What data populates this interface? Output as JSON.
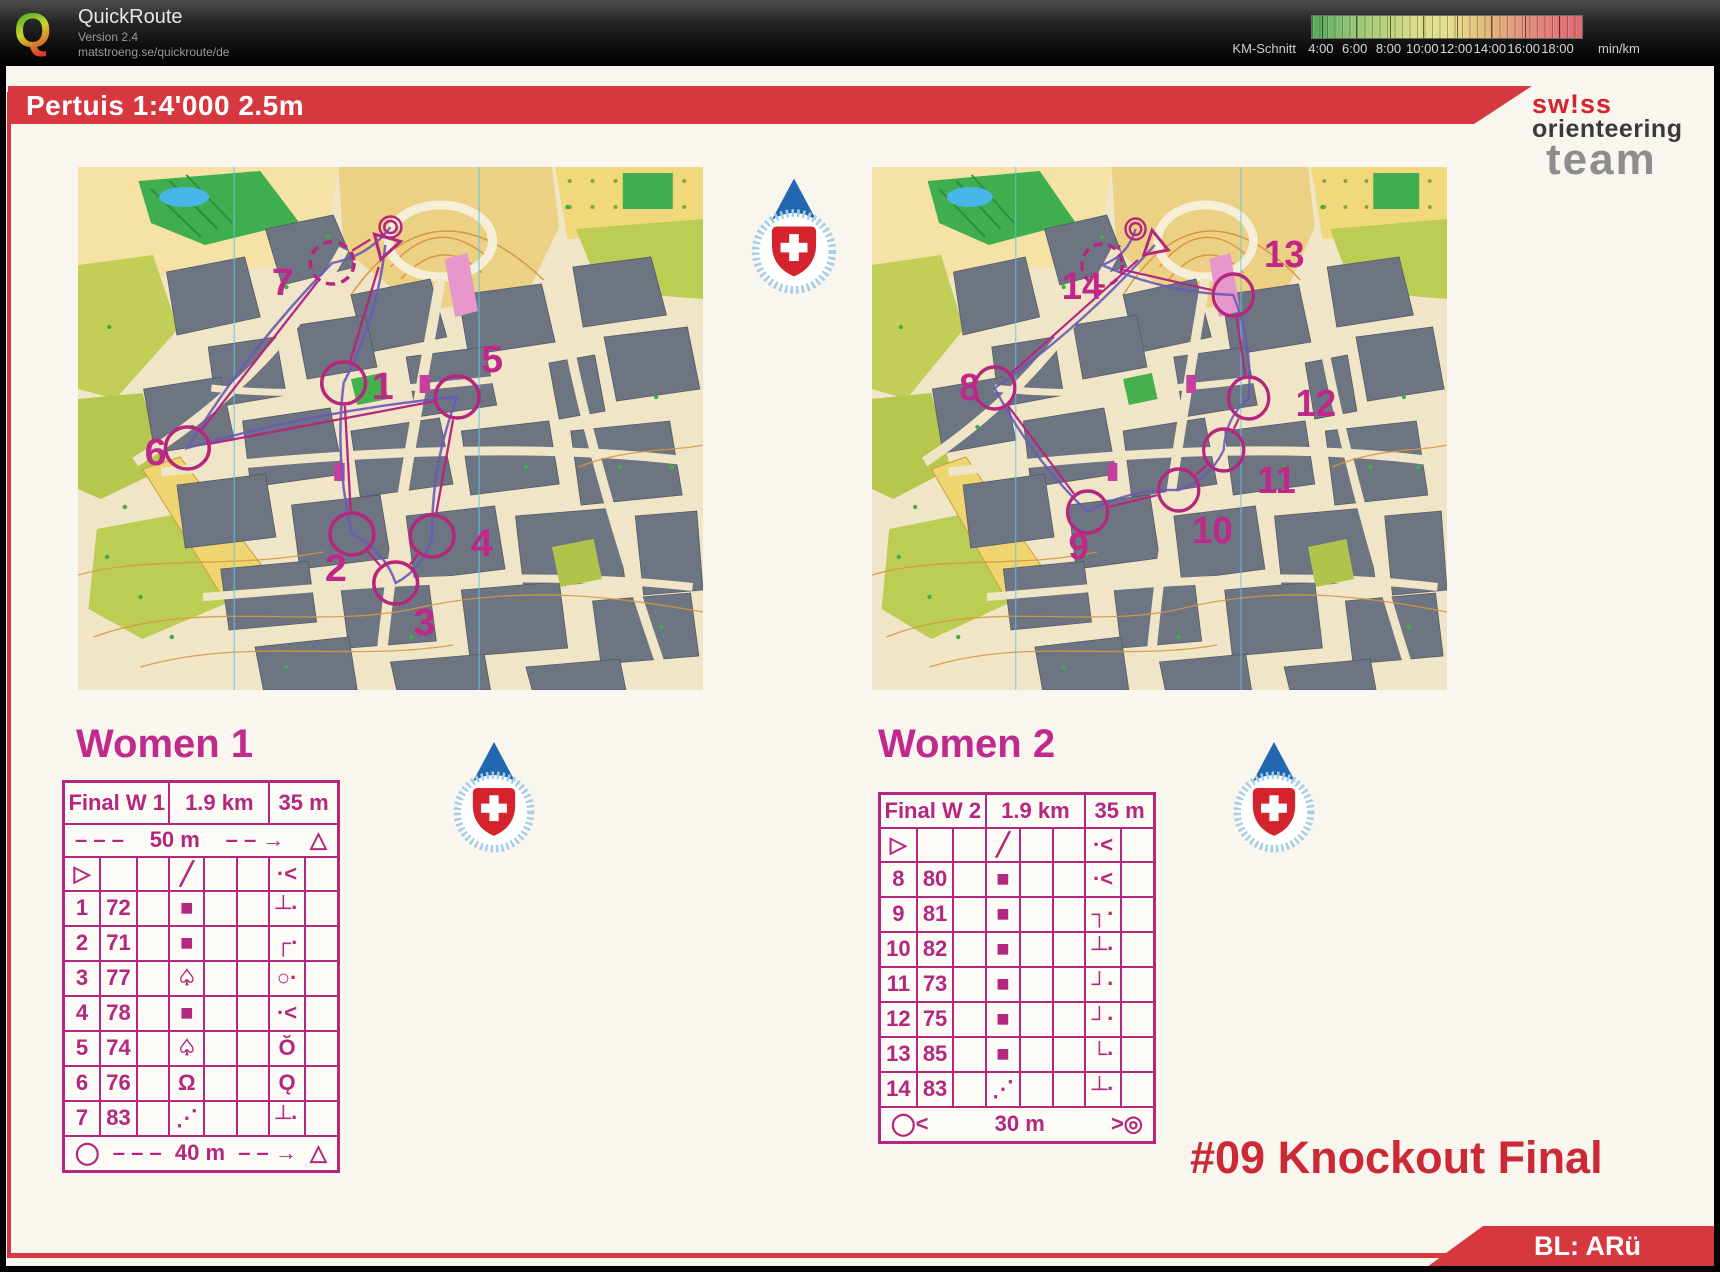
{
  "window": {
    "title": "QuickRoute",
    "version": "Version 2.4",
    "url": "matstroeng.se/quickroute/de"
  },
  "legend": {
    "label": "KM-Schnitt",
    "unit": "min/km",
    "ticks": [
      "4:00",
      "6:00",
      "8:00",
      "10:00",
      "12:00",
      "14:00",
      "16:00",
      "18:00"
    ],
    "colors": [
      "#55a85c",
      "#8cc273",
      "#b5d07c",
      "#d9dd85",
      "#e6e18a",
      "#e5c07d",
      "#e59a7e",
      "#e57d7d",
      "#df6a6e"
    ]
  },
  "sheet": {
    "map_title": "Pertuis 1:4'000 2.5m",
    "event_title": "#09 Knockout Final",
    "footer_tag": "BL: ARü",
    "logo_lines": [
      "sw!ss",
      "orienteering",
      "team"
    ],
    "accent_red": "#d7383f",
    "course_magenta": "#b5267f",
    "route_purple": "#6a5ab8"
  },
  "courses": [
    {
      "heading": "Women 1",
      "header": [
        "Final W 1",
        "1.9 km",
        "35 m"
      ],
      "pre_cells": [
        "– – –",
        "50 m",
        "– – →",
        "△"
      ],
      "start_symbols": [
        "start-triangle",
        "",
        "",
        "ramp",
        "",
        "",
        "dot-angle",
        ""
      ],
      "rows": [
        {
          "num": "1",
          "code": "72",
          "d": "building",
          "h": "edge-dot"
        },
        {
          "num": "2",
          "code": "71",
          "d": "building",
          "h": "corner-nw-dot"
        },
        {
          "num": "3",
          "code": "77",
          "d": "tree",
          "h": "circle-dot"
        },
        {
          "num": "4",
          "code": "78",
          "d": "building",
          "h": "dot-angle"
        },
        {
          "num": "5",
          "code": "74",
          "d": "tree",
          "h": "hook"
        },
        {
          "num": "6",
          "code": "76",
          "d": "statue",
          "h": "loop"
        },
        {
          "num": "7",
          "code": "83",
          "d": "stairs",
          "h": "edge-dot"
        }
      ],
      "finish_cells": [
        "◯",
        "– – –",
        "40 m",
        "– – →",
        "△"
      ],
      "dashed_controls": [
        "7"
      ],
      "controls": [
        {
          "label": "1",
          "cx": 255,
          "cy": 216,
          "lx": 282,
          "ly": 232
        },
        {
          "label": "2",
          "cx": 263,
          "cy": 367,
          "lx": 237,
          "ly": 414
        },
        {
          "label": "3",
          "cx": 305,
          "cy": 416,
          "lx": 322,
          "ly": 468
        },
        {
          "label": "4",
          "cx": 340,
          "cy": 369,
          "lx": 377,
          "ly": 389
        },
        {
          "label": "5",
          "cx": 364,
          "cy": 230,
          "lx": 387,
          "ly": 205
        },
        {
          "label": "6",
          "cx": 105,
          "cy": 281,
          "lx": 64,
          "ly": 298
        },
        {
          "label": "7",
          "cx": 244,
          "cy": 96,
          "lx": 186,
          "ly": 128
        }
      ],
      "route": [
        [
          295,
          78
        ],
        [
          255,
          216
        ],
        [
          263,
          367
        ],
        [
          305,
          416
        ],
        [
          340,
          369
        ],
        [
          364,
          230
        ],
        [
          105,
          281
        ],
        [
          244,
          96
        ],
        [
          300,
          60
        ]
      ]
    },
    {
      "heading": "Women 2",
      "header": [
        "Final W 2",
        "1.9 km",
        "35 m"
      ],
      "pre_cells": null,
      "start_symbols": [
        "start-triangle",
        "",
        "",
        "ramp",
        "",
        "",
        "dot-angle",
        ""
      ],
      "rows": [
        {
          "num": "8",
          "code": "80",
          "d": "building",
          "h": "dot-angle"
        },
        {
          "num": "9",
          "code": "81",
          "d": "building",
          "h": "corner-ne-dot"
        },
        {
          "num": "10",
          "code": "82",
          "d": "building",
          "h": "edge-dot"
        },
        {
          "num": "11",
          "code": "73",
          "d": "building",
          "h": "corner-se-dot"
        },
        {
          "num": "12",
          "code": "75",
          "d": "building",
          "h": "corner-se-dot"
        },
        {
          "num": "13",
          "code": "85",
          "d": "building",
          "h": "corner-sw-dot"
        },
        {
          "num": "14",
          "code": "83",
          "d": "stairs",
          "h": "edge-dot"
        }
      ],
      "finish_cells": [
        "◯<",
        "",
        "30 m",
        "",
        ">◎"
      ],
      "dashed_controls": [
        "14"
      ],
      "controls": [
        {
          "label": "8",
          "cx": 128,
          "cy": 221,
          "lx": 91,
          "ly": 233
        },
        {
          "label": "9",
          "cx": 225,
          "cy": 345,
          "lx": 205,
          "ly": 392
        },
        {
          "label": "10",
          "cx": 320,
          "cy": 323,
          "lx": 334,
          "ly": 376
        },
        {
          "label": "11",
          "cx": 367,
          "cy": 283,
          "lx": 402,
          "ly": 326
        },
        {
          "label": "12",
          "cx": 393,
          "cy": 231,
          "lx": 442,
          "ly": 249
        },
        {
          "label": "13",
          "cx": 377,
          "cy": 128,
          "lx": 409,
          "ly": 100
        },
        {
          "label": "14",
          "cx": 240,
          "cy": 98,
          "lx": 198,
          "ly": 132
        }
      ],
      "route": [
        [
          295,
          78
        ],
        [
          128,
          221
        ],
        [
          225,
          345
        ],
        [
          320,
          323
        ],
        [
          367,
          283
        ],
        [
          393,
          231
        ],
        [
          377,
          128
        ],
        [
          240,
          98
        ],
        [
          275,
          62
        ]
      ]
    }
  ]
}
